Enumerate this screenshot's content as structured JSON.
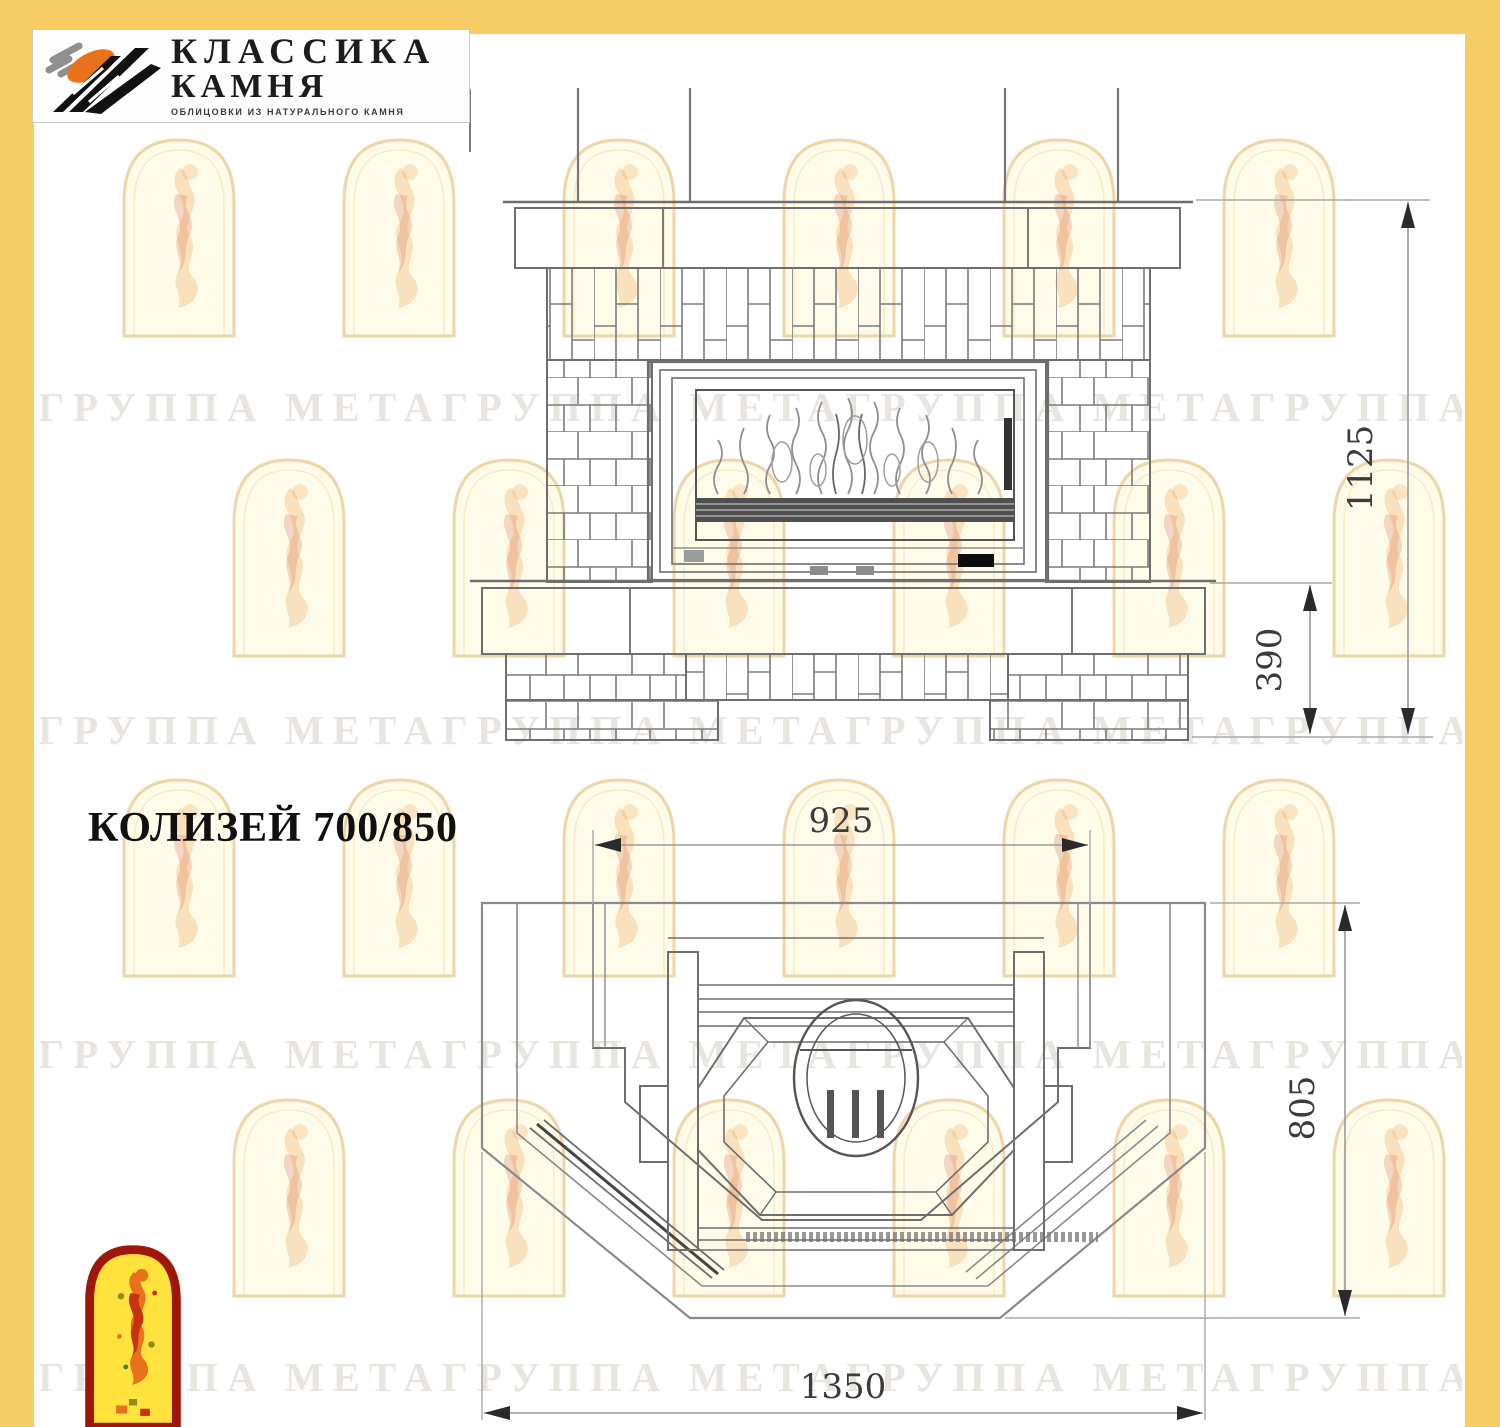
{
  "brand": {
    "line1": "КЛАССИКА",
    "line2": "КАМНЯ",
    "subtitle": "ОБЛИЦОВКИ ИЗ НАТУРАЛЬНОГО КАМНЯ"
  },
  "title": "КОЛИЗЕЙ 700/850",
  "watermark": {
    "row_text": "ГРУППА МЕТАГРУППА МЕТАГРУППА МЕТАГРУППА МЕТА"
  },
  "front_view": {
    "dim_height_total": "1125",
    "dim_height_hearth": "390"
  },
  "plan_view": {
    "dim_width_front": "925",
    "dim_depth": "805",
    "dim_width_total": "1350"
  },
  "colors": {
    "frame_yellow": "#F5CD64",
    "logo_arch_red": "#9E1708",
    "logo_arch_yellow": "#FFE23C",
    "logo_orange": "#E8721C",
    "logo_flame_red": "#C63212"
  }
}
